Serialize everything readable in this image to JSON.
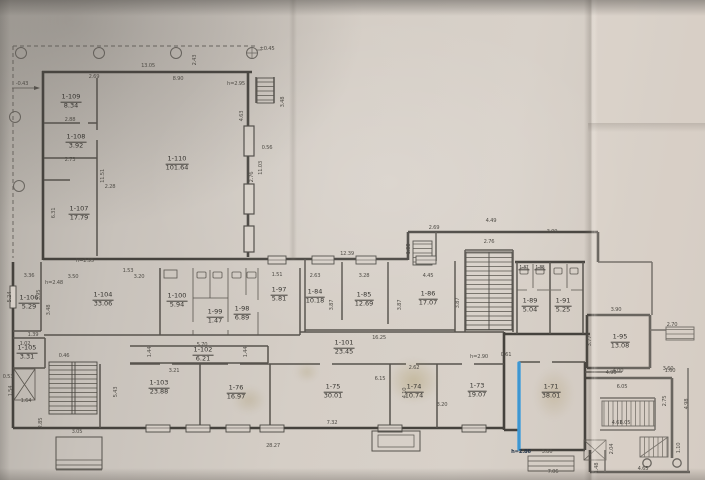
{
  "plan": {
    "paper_color": "#d5cec6",
    "ink_color": "#4a4742",
    "highlight_color": "#3ea2e5",
    "rooms": [
      {
        "id": "1-109",
        "area": "8.34",
        "x": 71,
        "y": 102
      },
      {
        "id": "1-108",
        "area": "3.92",
        "x": 76,
        "y": 142
      },
      {
        "id": "1-107",
        "area": "17.79",
        "x": 79,
        "y": 214
      },
      {
        "id": "1-110",
        "area": "101.64",
        "x": 177,
        "y": 164
      },
      {
        "id": "1-106",
        "area": "5.29",
        "x": 29,
        "y": 303
      },
      {
        "id": "1-105",
        "area": "3.31",
        "x": 27,
        "y": 353
      },
      {
        "id": "1-104",
        "area": "33.06",
        "x": 103,
        "y": 300
      },
      {
        "id": "1-100",
        "area": "5.94",
        "x": 177,
        "y": 301
      },
      {
        "id": "1-99",
        "area": "1.47",
        "x": 215,
        "y": 317
      },
      {
        "id": "1-98",
        "area": "6.89",
        "x": 242,
        "y": 314
      },
      {
        "id": "1-97",
        "area": "5.81",
        "x": 279,
        "y": 295
      },
      {
        "id": "1-84",
        "area": "10.18",
        "x": 315,
        "y": 297
      },
      {
        "id": "1-85",
        "area": "12.69",
        "x": 364,
        "y": 300
      },
      {
        "id": "1-86",
        "area": "17.07",
        "x": 428,
        "y": 299
      },
      {
        "id": "1-101",
        "area": "23.45",
        "x": 344,
        "y": 348
      },
      {
        "id": "1-102",
        "area": "6.21",
        "x": 203,
        "y": 355
      },
      {
        "id": "1-103",
        "area": "23.88",
        "x": 159,
        "y": 388
      },
      {
        "id": "1-76",
        "area": "16.97",
        "x": 236,
        "y": 393
      },
      {
        "id": "1-75",
        "area": "30.01",
        "x": 333,
        "y": 392
      },
      {
        "id": "1-74",
        "area": "10.74",
        "x": 414,
        "y": 392
      },
      {
        "id": "1-73",
        "area": "19.07",
        "x": 477,
        "y": 391
      },
      {
        "id": "1-71",
        "area": "38.01",
        "x": 551,
        "y": 392
      },
      {
        "id": "1-89",
        "area": "5.04",
        "x": 530,
        "y": 306
      },
      {
        "id": "1-91",
        "area": "5.25",
        "x": 563,
        "y": 306
      },
      {
        "id": "1-95",
        "area": "13.08",
        "x": 620,
        "y": 342
      },
      {
        "id": "1-87",
        "area": "",
        "x": 524,
        "y": 268,
        "small": true
      },
      {
        "id": "1-88",
        "area": "",
        "x": 540,
        "y": 268,
        "small": true
      }
    ],
    "dims": [
      {
        "t": "-0.43",
        "x": 22,
        "y": 84
      },
      {
        "t": "±0.45",
        "x": 267,
        "y": 49
      },
      {
        "t": "13.05",
        "x": 148,
        "y": 66
      },
      {
        "t": "2.69",
        "x": 94,
        "y": 77
      },
      {
        "t": "8.90",
        "x": 178,
        "y": 79
      },
      {
        "t": "h=2.95",
        "x": 236,
        "y": 84
      },
      {
        "t": "3.48",
        "x": 283,
        "y": 102,
        "r": 90
      },
      {
        "t": "2.43",
        "x": 195,
        "y": 60,
        "r": 90
      },
      {
        "t": "2.88",
        "x": 70,
        "y": 120
      },
      {
        "t": "2.73",
        "x": 70,
        "y": 160
      },
      {
        "t": "2.28",
        "x": 110,
        "y": 187
      },
      {
        "t": "11.51",
        "x": 103,
        "y": 176,
        "r": 90
      },
      {
        "t": "6.31",
        "x": 54,
        "y": 213,
        "r": 90
      },
      {
        "t": "4.63",
        "x": 242,
        "y": 116,
        "r": 90
      },
      {
        "t": "0.56",
        "x": 267,
        "y": 148
      },
      {
        "t": "11.03",
        "x": 261,
        "y": 168,
        "r": 90
      },
      {
        "t": "2.76",
        "x": 252,
        "y": 177,
        "r": 90
      },
      {
        "t": "h=2.95",
        "x": 85,
        "y": 261
      },
      {
        "t": "h=2.48",
        "x": 54,
        "y": 283
      },
      {
        "t": "3.36",
        "x": 29,
        "y": 276
      },
      {
        "t": "3.50",
        "x": 73,
        "y": 277
      },
      {
        "t": "1.53",
        "x": 128,
        "y": 271
      },
      {
        "t": "3.20",
        "x": 139,
        "y": 277
      },
      {
        "t": "5.24",
        "x": 10,
        "y": 297,
        "r": 90
      },
      {
        "t": "3.95",
        "x": 39,
        "y": 295,
        "r": 90
      },
      {
        "t": "3.48",
        "x": 49,
        "y": 310,
        "r": 90
      },
      {
        "t": "1.39",
        "x": 33,
        "y": 335
      },
      {
        "t": "1.02",
        "x": 25,
        "y": 344
      },
      {
        "t": "0.46",
        "x": 64,
        "y": 356
      },
      {
        "t": "0.53",
        "x": 8,
        "y": 377
      },
      {
        "t": "1.54",
        "x": 11,
        "y": 391,
        "r": 90
      },
      {
        "t": "1.64",
        "x": 26,
        "y": 401
      },
      {
        "t": "2.85",
        "x": 41,
        "y": 423,
        "r": 90
      },
      {
        "t": "3.05",
        "x": 77,
        "y": 432
      },
      {
        "t": "5.70",
        "x": 202,
        "y": 345
      },
      {
        "t": "1.44",
        "x": 150,
        "y": 352,
        "r": 90
      },
      {
        "t": "1.44",
        "x": 246,
        "y": 352,
        "r": 90
      },
      {
        "t": "3.21",
        "x": 174,
        "y": 371
      },
      {
        "t": "5.43",
        "x": 116,
        "y": 392,
        "r": 90
      },
      {
        "t": "7.32",
        "x": 332,
        "y": 423
      },
      {
        "t": "2.62",
        "x": 414,
        "y": 368
      },
      {
        "t": "6.15",
        "x": 380,
        "y": 379
      },
      {
        "t": "4.10",
        "x": 405,
        "y": 393,
        "r": 90
      },
      {
        "t": "3.20",
        "x": 442,
        "y": 405
      },
      {
        "t": "h=2.90",
        "x": 479,
        "y": 357
      },
      {
        "t": "0.61",
        "x": 506,
        "y": 355
      },
      {
        "t": "28.27",
        "x": 273,
        "y": 446
      },
      {
        "t": "7.06",
        "x": 553,
        "y": 472
      },
      {
        "t": "4.61",
        "x": 617,
        "y": 423
      },
      {
        "t": "3.86",
        "x": 547,
        "y": 452
      },
      {
        "t": "h=2.86",
        "x": 521,
        "y": 452,
        "hl": true
      },
      {
        "t": "4.90",
        "x": 611,
        "y": 373
      },
      {
        "t": "3.60",
        "x": 668,
        "y": 369
      },
      {
        "t": "6.05",
        "x": 622,
        "y": 387
      },
      {
        "t": "6.05",
        "x": 625,
        "y": 423
      },
      {
        "t": "2.75",
        "x": 665,
        "y": 401,
        "r": 90
      },
      {
        "t": "4.98",
        "x": 687,
        "y": 404,
        "r": 90
      },
      {
        "t": "2.04",
        "x": 612,
        "y": 449,
        "r": 90
      },
      {
        "t": "1.10",
        "x": 679,
        "y": 448,
        "r": 90
      },
      {
        "t": "4.65",
        "x": 643,
        "y": 469
      },
      {
        "t": "1.48",
        "x": 597,
        "y": 468,
        "r": 90
      },
      {
        "t": "3.90",
        "x": 616,
        "y": 310
      },
      {
        "t": "2.70",
        "x": 672,
        "y": 325
      },
      {
        "t": "3.77",
        "x": 590,
        "y": 341,
        "r": 90
      },
      {
        "t": "4.00",
        "x": 618,
        "y": 371
      },
      {
        "t": "1.60",
        "x": 670,
        "y": 371
      },
      {
        "t": "12.39",
        "x": 347,
        "y": 254
      },
      {
        "t": "2.63",
        "x": 315,
        "y": 276
      },
      {
        "t": "3.28",
        "x": 364,
        "y": 276
      },
      {
        "t": "4.45",
        "x": 428,
        "y": 276
      },
      {
        "t": "3.87",
        "x": 332,
        "y": 305,
        "r": 90
      },
      {
        "t": "3.87",
        "x": 400,
        "y": 305,
        "r": 90
      },
      {
        "t": "3.87",
        "x": 458,
        "y": 303,
        "r": 90
      },
      {
        "t": "16.25",
        "x": 379,
        "y": 338
      },
      {
        "t": "4.49",
        "x": 491,
        "y": 221
      },
      {
        "t": "2.69",
        "x": 434,
        "y": 228
      },
      {
        "t": "2.76",
        "x": 489,
        "y": 242
      },
      {
        "t": "3.09",
        "x": 552,
        "y": 232
      },
      {
        "t": "1.88",
        "x": 409,
        "y": 249,
        "r": 90
      },
      {
        "t": "1.51",
        "x": 277,
        "y": 275
      }
    ]
  }
}
